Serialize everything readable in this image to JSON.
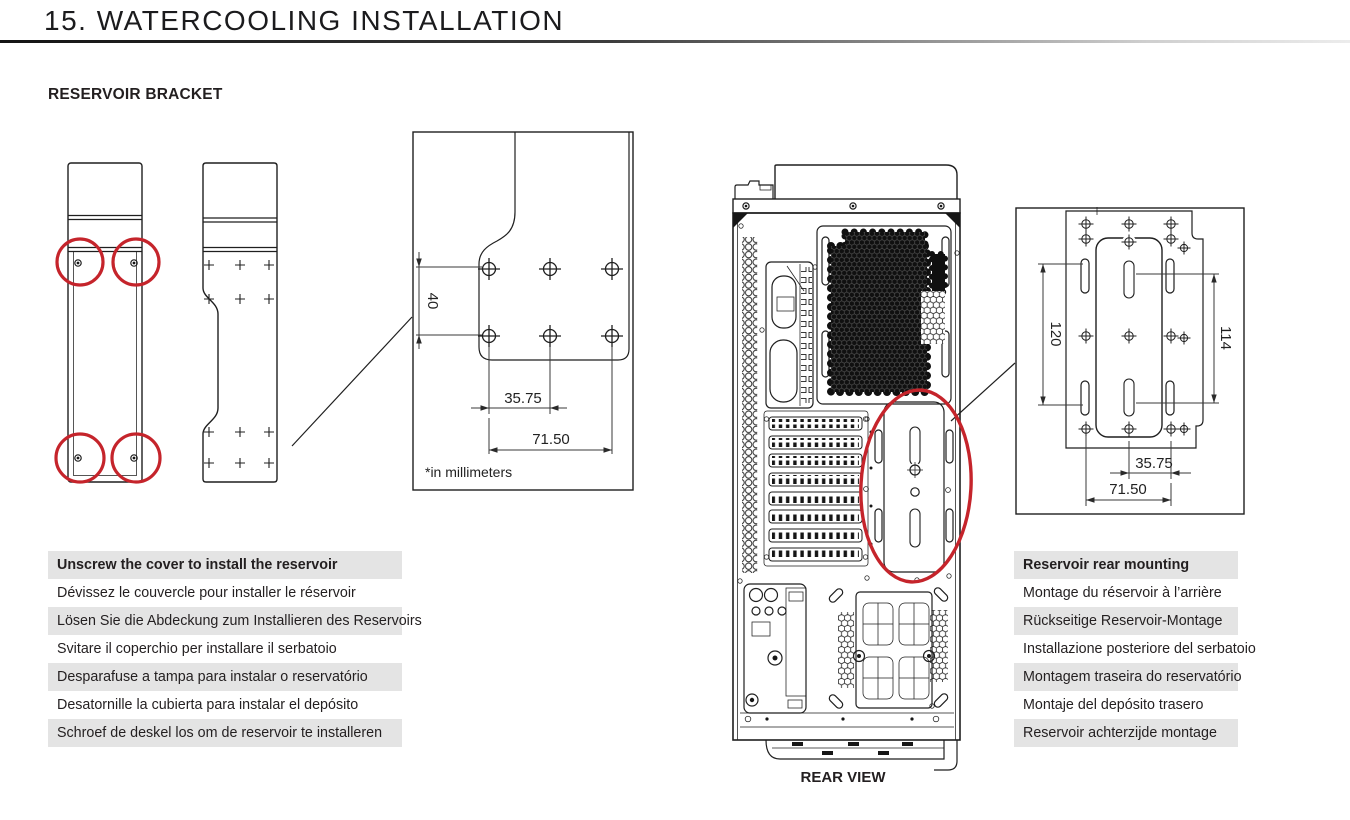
{
  "colors": {
    "accent_red": "#c5242b",
    "ink": "#231f20",
    "row_gray": "#e4e4e4",
    "line": "#1f1f1f"
  },
  "page": {
    "title": "15. WATERCOOLING INSTALLATION",
    "section": "RESERVOIR BRACKET",
    "rear_view_label": "REAR VIEW",
    "units_note": "*in millimeters"
  },
  "bracket_detail": {
    "dim_height": "40",
    "dim_spacing": "35.75",
    "dim_width": "71.50"
  },
  "rear_detail": {
    "dim_slot_height": "120",
    "dim_hole_height": "114",
    "dim_spacing": "35.75",
    "dim_width": "71.50"
  },
  "instructions_cover": {
    "en": "Unscrew the cover to install the reservoir",
    "fr": "Dévissez le couvercle pour installer le réservoir",
    "de": "Lösen Sie die Abdeckung zum Installieren des Reservoirs",
    "it": "Svitare il coperchio per installare il serbatoio",
    "pt": "Desparafuse a tampa para instalar o reservatório",
    "es": "Desatornille la cubierta para instalar el depósito",
    "nl": "Schroef de deskel los om de reservoir te installeren"
  },
  "instructions_rear": {
    "en": "Reservoir rear mounting",
    "fr": "Montage du réservoir à l’arrière",
    "de": "Rückseitige Reservoir-Montage",
    "it": "Installazione posteriore del serbatoio",
    "pt": "Montagem traseira do reservatório",
    "es": "Montaje del depósito trasero",
    "nl": "Reservoir achterzijde montage"
  }
}
